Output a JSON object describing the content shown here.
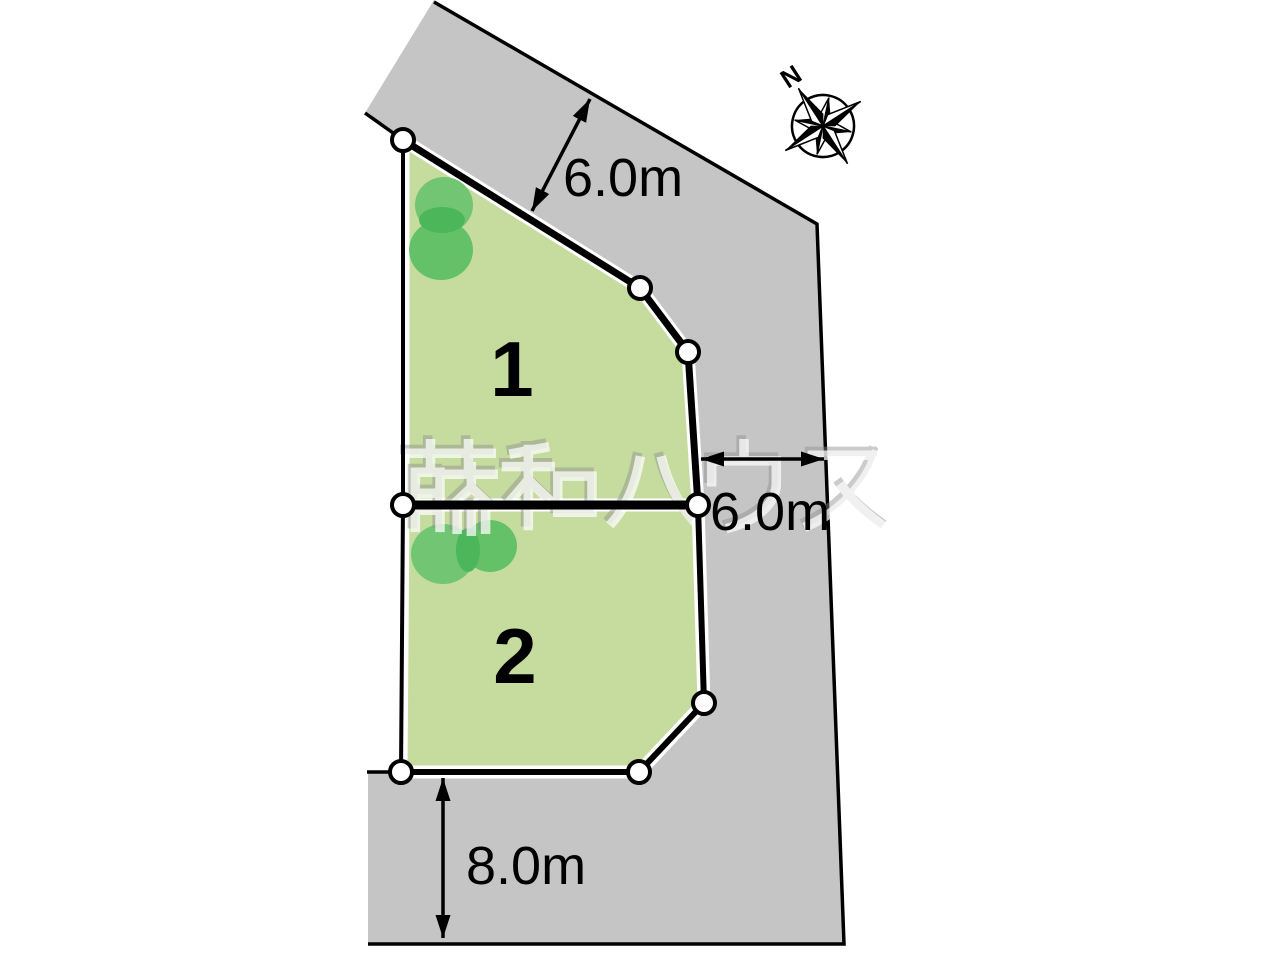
{
  "plan": {
    "type": "residential-lot-layout",
    "lots": [
      {
        "number": "1"
      },
      {
        "number": "2"
      }
    ],
    "dimensions": {
      "north_road_width": "6.0m",
      "east_road_width": "6.0m",
      "south_road_width": "8.0m"
    },
    "compass": {
      "label": "N"
    },
    "watermark": {
      "text": "藤和ハウス"
    },
    "colors": {
      "road_gray": "#c5c5c5",
      "lot_green": "#c5dc9e",
      "tree_green_light": "#72c573",
      "tree_green_mid": "#65c167",
      "tree_green_dark": "#4cb65a",
      "line_black": "#000000",
      "survey_point_fill": "#ffffff"
    }
  }
}
